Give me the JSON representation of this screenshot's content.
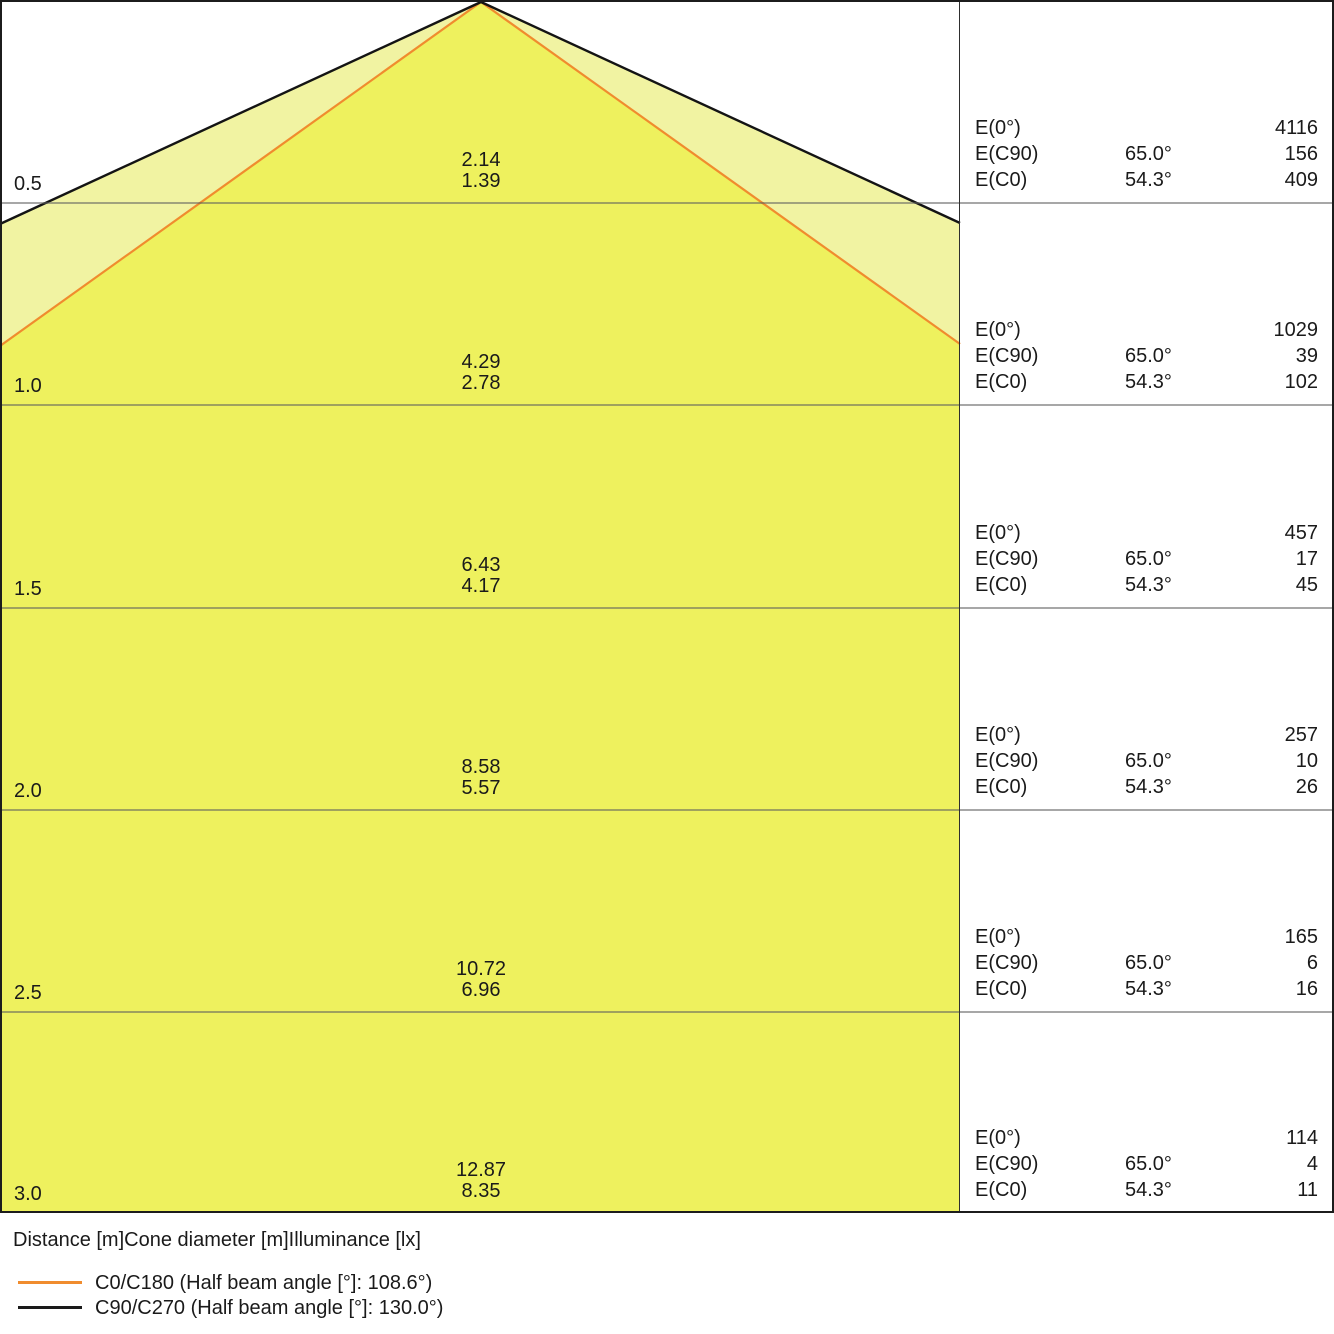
{
  "rows": [
    {
      "distance": "0.5",
      "cone_diameter_c90": "2.14",
      "cone_diameter_c0": "1.39",
      "e0": "4116",
      "ec90": "156",
      "ec0": "409"
    },
    {
      "distance": "1.0",
      "cone_diameter_c90": "4.29",
      "cone_diameter_c0": "2.78",
      "e0": "1029",
      "ec90": "39",
      "ec0": "102"
    },
    {
      "distance": "1.5",
      "cone_diameter_c90": "6.43",
      "cone_diameter_c0": "4.17",
      "e0": "457",
      "ec90": "17",
      "ec0": "45"
    },
    {
      "distance": "2.0",
      "cone_diameter_c90": "8.58",
      "cone_diameter_c0": "5.57",
      "e0": "257",
      "ec90": "10",
      "ec0": "26"
    },
    {
      "distance": "2.5",
      "cone_diameter_c90": "10.72",
      "cone_diameter_c0": "6.96",
      "e0": "165",
      "ec90": "6",
      "ec0": "16"
    },
    {
      "distance": "3.0",
      "cone_diameter_c90": "12.87",
      "cone_diameter_c0": "8.35",
      "e0": "114",
      "ec90": "4",
      "ec0": "11"
    }
  ],
  "table_labels": {
    "e0": "E(0°)",
    "ec90": "E(C90)",
    "ec0": "E(C0)",
    "angle_c90": "65.0°",
    "angle_c0": "54.3°"
  },
  "footer": {
    "columns_label": "Distance [m]Cone diameter [m]Illuminance [lx]"
  },
  "legend": [
    {
      "label": "C0/C180 (Half beam angle [°]: 108.6°)",
      "color": "#f08c2e"
    },
    {
      "label": "C90/C270 (Half beam angle [°]: 130.0°)",
      "color": "#1a1a1a"
    }
  ],
  "colors": {
    "cone_c0_fill": "#eef15e",
    "cone_c90_fill": "#f1f3a2",
    "cone_c0_edge": "#f08c2e",
    "cone_c90_edge": "#141414"
  },
  "chart_data": {
    "type": "table",
    "columns": [
      "Distance [m]",
      "Cone diameter C90/C270 [m]",
      "Cone diameter C0/C180 [m]",
      "E(0°) [lx]",
      "E(C90) [lx]",
      "E(C0) [lx]"
    ],
    "rows": [
      [
        0.5,
        2.14,
        1.39,
        4116,
        156,
        409
      ],
      [
        1.0,
        4.29,
        2.78,
        1029,
        39,
        102
      ],
      [
        1.5,
        6.43,
        4.17,
        457,
        17,
        45
      ],
      [
        2.0,
        8.58,
        5.57,
        257,
        10,
        26
      ],
      [
        2.5,
        10.72,
        6.96,
        165,
        6,
        16
      ],
      [
        3.0,
        12.87,
        8.35,
        114,
        4,
        11
      ]
    ],
    "eval_angles": {
      "E(C90)": "65.0°",
      "E(C0)": "54.3°"
    },
    "half_beam_angles_deg": {
      "C0/C180": 108.6,
      "C90/C270": 130.0
    }
  }
}
